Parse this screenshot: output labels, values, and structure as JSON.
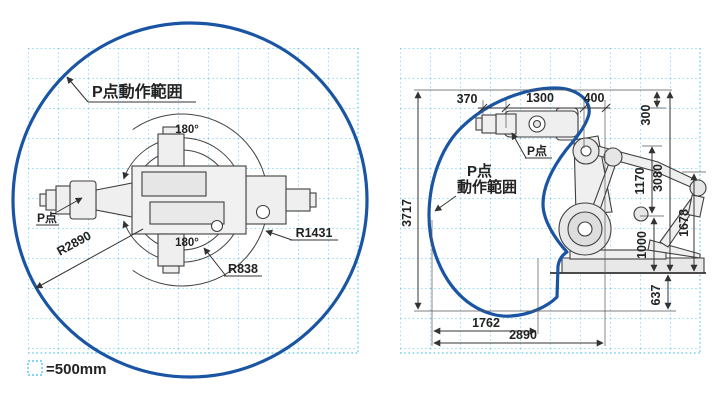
{
  "legend": {
    "unit_label": "=500mm"
  },
  "left_diagram": {
    "range_label": "P点動作範囲",
    "p_point_label": "P点",
    "angle_top": "180°",
    "angle_bottom": "180°",
    "radius_outer": "R2890",
    "radius_mid": "R1431",
    "radius_inner": "R838"
  },
  "right_diagram": {
    "p_point_label": "P点",
    "range_label_line1": "P点",
    "range_label_line2": "動作範囲",
    "dims": {
      "d370": "370",
      "d1300": "1300",
      "d400": "400",
      "d300": "300",
      "d3717": "3717",
      "d1170": "1170",
      "d3080": "3080",
      "d1678": "1678",
      "d1000": "1000",
      "d637": "637",
      "d1762": "1762",
      "d2890": "2890"
    }
  },
  "colors": {
    "envelope": "#1a55a4",
    "grid": "#5ec6f0",
    "line": "#333333"
  }
}
